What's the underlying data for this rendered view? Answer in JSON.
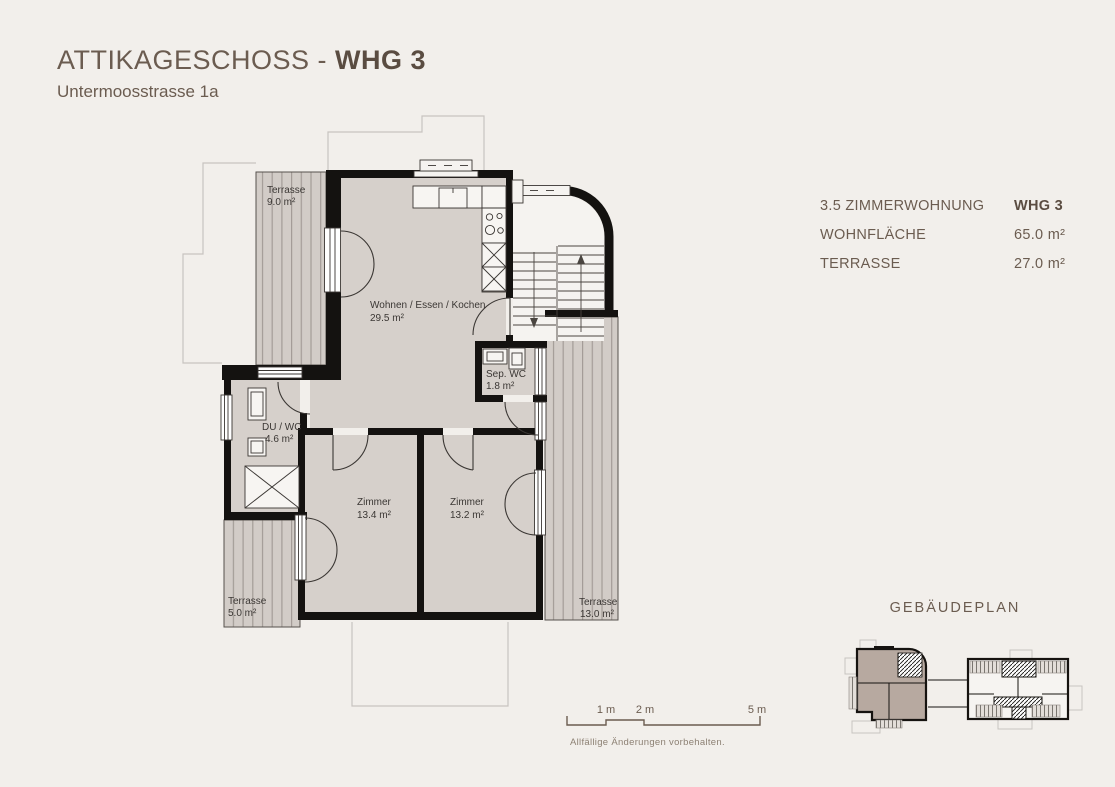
{
  "header": {
    "title_prefix": "ATTIKAGESCHOSS - ",
    "title_unit": "WHG 3",
    "subtitle": "Untermoosstrasse 1a"
  },
  "info_panel": {
    "rows": [
      {
        "label": "3.5 ZIMMERWOHNUNG",
        "value": "WHG 3"
      },
      {
        "label": "WOHNFLÄCHE",
        "value": "65.0 m²"
      },
      {
        "label": "TERRASSE",
        "value": "27.0 m²"
      }
    ]
  },
  "floorplan": {
    "rooms": {
      "terrasse_top": {
        "name": "Terrasse",
        "area": "9.0 m²"
      },
      "living": {
        "name": "Wohnen / Essen / Kochen",
        "area": "29.5 m²"
      },
      "sep_wc": {
        "name": "Sep. WC",
        "area": "1.8 m²"
      },
      "du_wc": {
        "name": "DU / WC",
        "area": "4.6 m²"
      },
      "zimmer_left": {
        "name": "Zimmer",
        "area": "13.4 m²"
      },
      "zimmer_right": {
        "name": "Zimmer",
        "area": "13.2 m²"
      },
      "terrasse_bl": {
        "name": "Terrasse",
        "area": "5.0 m²"
      },
      "terrasse_r": {
        "name": "Terrasse",
        "area": "13.0 m²"
      }
    }
  },
  "building_plan": {
    "title": "GEBÄUDEPLAN"
  },
  "scale_bar": {
    "labels": [
      "1 m",
      "2 m",
      "5 m"
    ]
  },
  "footer": {
    "disclaimer": "Allfällige Änderungen vorbehalten."
  },
  "colors": {
    "background": "#f2efeb",
    "accent_text": "#6b5c50",
    "wall": "#141210",
    "room_fill": "#d6d0cb",
    "terrace_fill": "#d2ccc7",
    "terrace_stripe": "#a39c97",
    "label_text": "#3b3734",
    "highlight_unit": "#b7a9a0"
  }
}
